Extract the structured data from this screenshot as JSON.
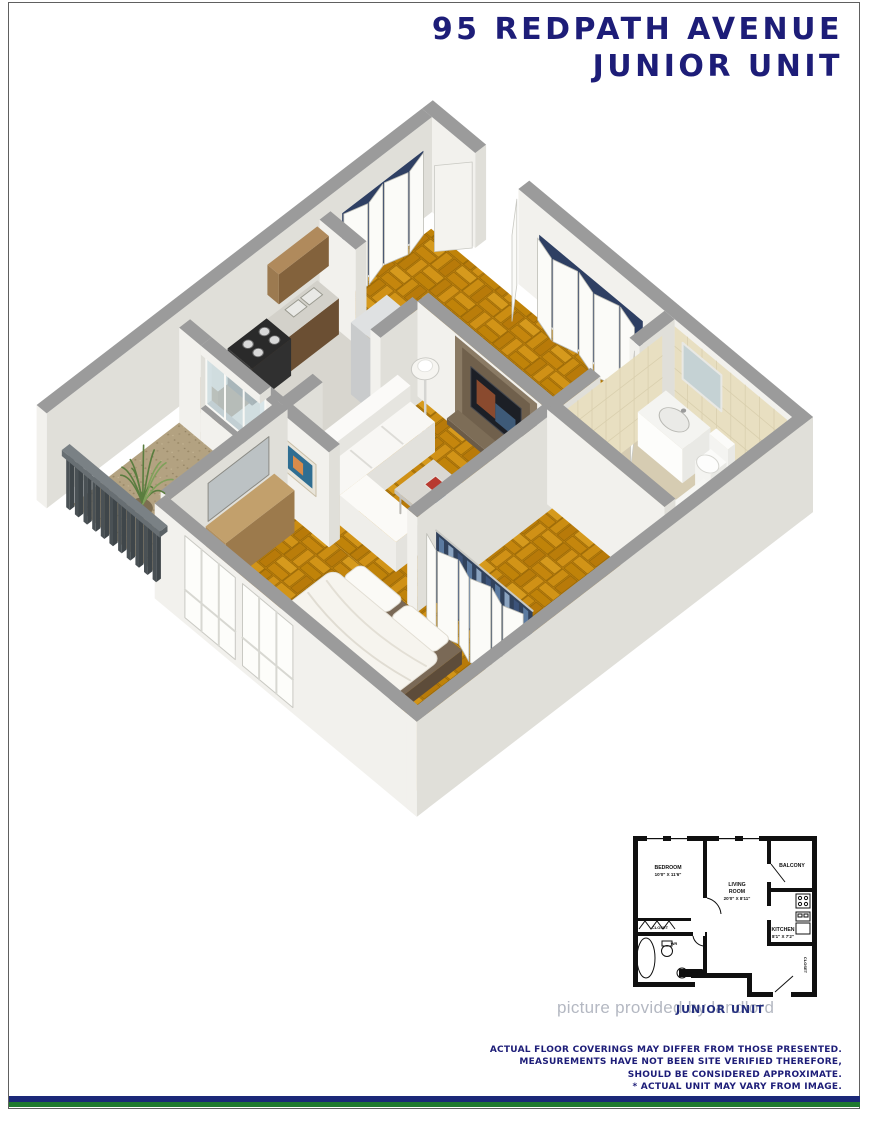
{
  "title": {
    "line1": "95 REDPATH AVENUE",
    "line2": "JUNIOR UNIT"
  },
  "miniplan": {
    "bedroom_name": "BEDROOM",
    "bedroom_dims": "10'0\" X 11'6\"",
    "living_l1": "LIVING",
    "living_l2": "ROOM",
    "living_dims": "20'0\" X 8'11\"",
    "balcony": "BALCONY",
    "kitchen_name": "KITCHEN",
    "kitchen_dims": "8'1\" X 7'2\"",
    "closet_bedroom": "CLOSET",
    "closet_entry": "CLOSET",
    "foyer": "FOYER",
    "washroom": "WR"
  },
  "watermark": {
    "gray_text": "picture provided by landlord",
    "overlay_text": "JUNIOR UNIT"
  },
  "disclaimer": {
    "lines": [
      "ACTUAL FLOOR COVERINGS MAY DIFFER FROM THOSE PRESENTED.",
      "MEASUREMENTS HAVE NOT BEEN SITE VERIFIED THEREFORE,",
      "SHOULD BE CONSIDERED APPROXIMATE.",
      "* ACTUAL UNIT MAY VARY FROM IMAGE.",
      "© 2016 PLANIT MEASURING®"
    ]
  },
  "colors": {
    "navy": "#1d1d78",
    "band_navy": "#1b2878",
    "band_green": "#1f7a2f",
    "wall_top": "#9b9b9b",
    "wall_light": "#f2f1ed",
    "wall_shade": "#e0dfd9",
    "tile_beige": "#e8dfc1",
    "bath_floor": "#d6ccb2",
    "kitchen_floor": "#d8d6cf",
    "wood_cabinet": "#7e5f3f",
    "watermark_gray": "#b4b8c2"
  }
}
